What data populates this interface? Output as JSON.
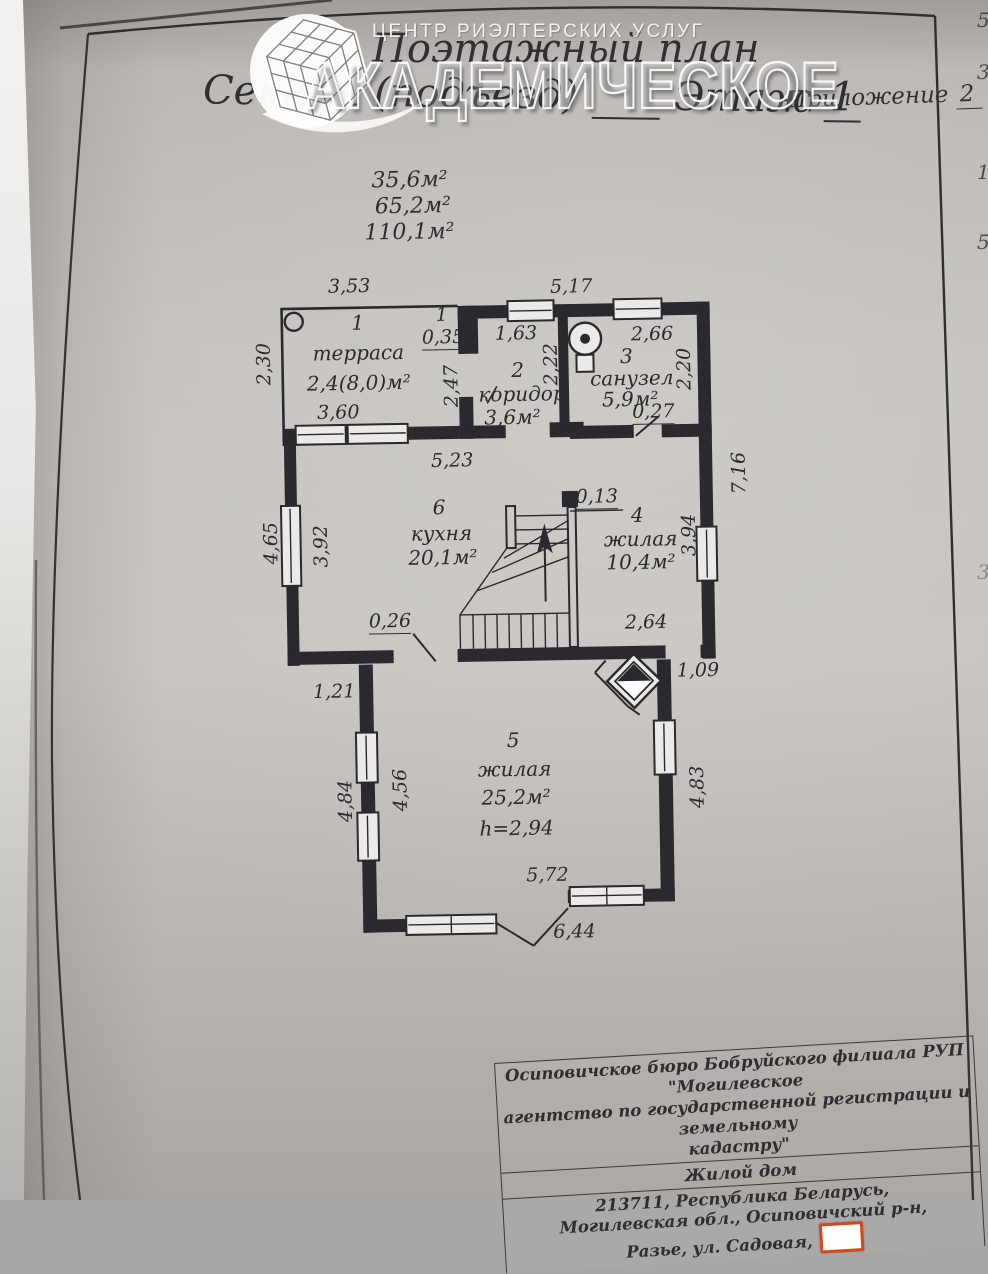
{
  "watermark": {
    "service_line": "ЦЕНТР РИЭЛТЕРСКИХ УСЛУГ",
    "brand": "АКАДЕМИЧЕСКОЕ"
  },
  "header": {
    "title": "Поэтажный план",
    "section_label": "Секция (подъезд)",
    "floor_label": "Этаж",
    "floor_value": "1",
    "annex_label": "Приложение",
    "annex_value": "2"
  },
  "summary_areas": [
    "35,6м²",
    "65,2м²",
    "110,1м²"
  ],
  "rooms": [
    {
      "number": "1",
      "name": "терраса",
      "area": "2,4(8,0)м²"
    },
    {
      "number": "2",
      "name": "коридор",
      "area": "3,6м²"
    },
    {
      "number": "3",
      "name": "санузел",
      "area": "5,9м²"
    },
    {
      "number": "4",
      "name": "жилая",
      "area": "10,4м²"
    },
    {
      "number": "5",
      "name": "жилая",
      "area": "25,2м²",
      "ceiling_height": "h=2,94"
    },
    {
      "number": "6",
      "name": "кухня",
      "area": "20,1м²"
    }
  ],
  "dimensions": {
    "terrace_top": "3,53",
    "terrace_left": "2,30",
    "terrace_bottom": "3,60",
    "pier_mark": "1",
    "pier_width": "0,35",
    "terrace_right": "2,47",
    "main_top": "5,17",
    "corridor_width": "1,63",
    "corridor_depth": "2,22",
    "bath_width": "2,66",
    "bath_depth": "2,20",
    "bath_door": "0,27",
    "kitchen_width": "5,23",
    "right_side_total": "7,16",
    "kitchen_depth": "3,92",
    "kitchen_left_out": "4,65",
    "stair_wall": "0,13",
    "room4_depth": "3,94",
    "kitchen_door": "0,26",
    "room4_width": "2,64",
    "step_left": "1,21",
    "step_right": "1,09",
    "room5_left_in": "4,56",
    "room5_left_out": "4,84",
    "room5_right": "4,83",
    "room5_bottom": "5,72",
    "bay_total": "6,44"
  },
  "footer": {
    "organization_line1": "Осиповичское бюро Бобруйского филиала РУП \"Могилевское",
    "organization_line2": "агентство по государственной регистрации и земельному",
    "organization_line3": "кадастру\"",
    "object_type": "Жилой дом",
    "address_line1": "213711, Республика Беларусь,",
    "address_line2": "Могилевская обл., Осиповичский р-н,",
    "address_line3": "Разье, ул. Садовая,"
  },
  "page_edge_glyphs": [
    "5",
    "3",
    "1",
    "5",
    "3"
  ],
  "colors": {
    "ink": "#2a292e",
    "paper": "#bdbab7",
    "redaction_border": "#d14a1e"
  }
}
